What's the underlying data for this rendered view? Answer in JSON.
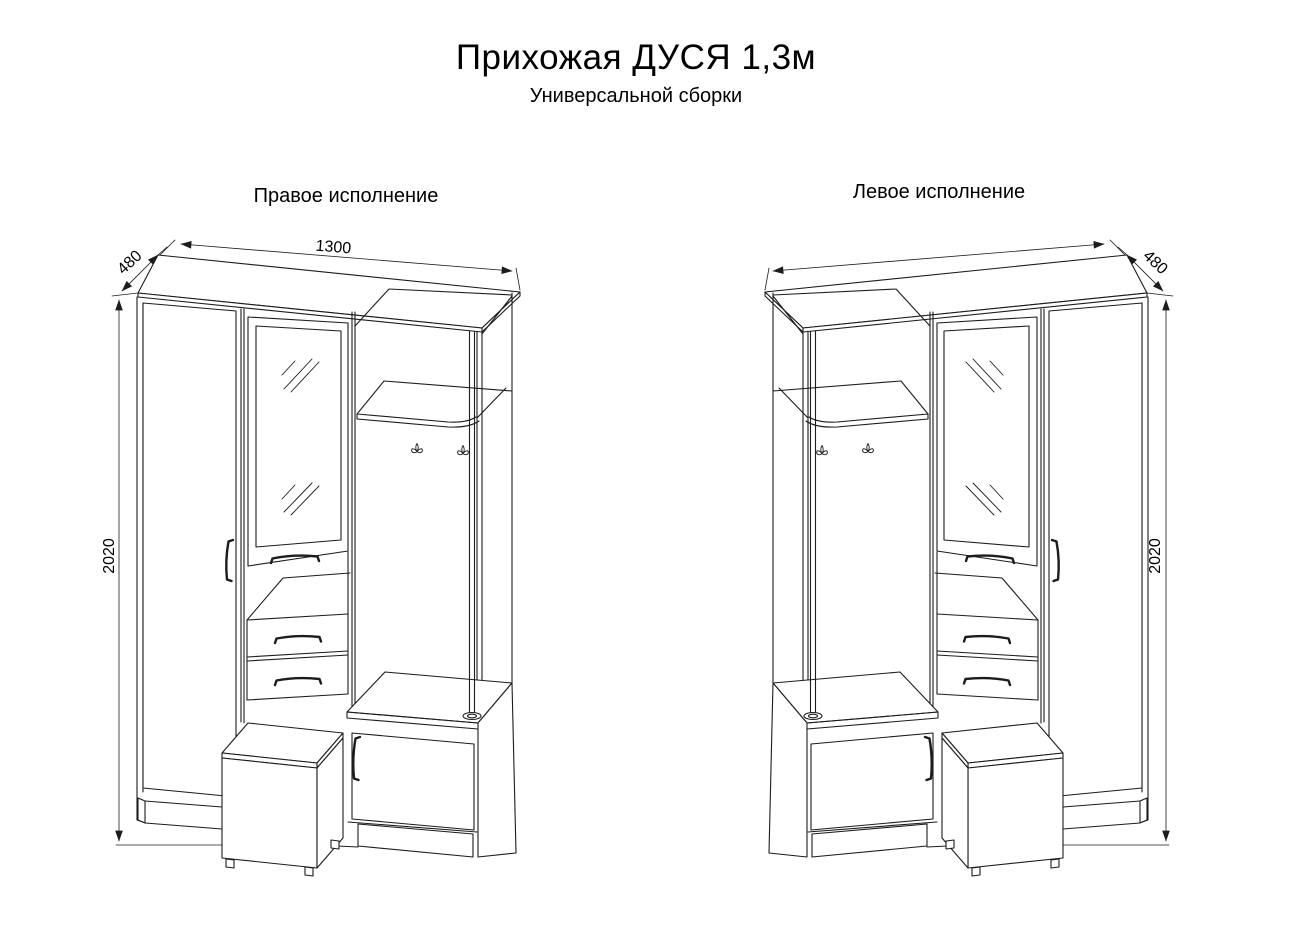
{
  "page": {
    "title": "Прихожая ДУСЯ 1,3м",
    "subtitle": "Универсальной сборки",
    "background_color": "#ffffff",
    "line_color": "#1c1c1c",
    "text_color": "#000000"
  },
  "drawings": [
    {
      "id": "right-version",
      "label": "Правое исполнение",
      "dimensions": {
        "width": "1300",
        "depth": "480",
        "height": "2020"
      },
      "parts": [
        "top-panel",
        "wardrobe-door",
        "mirror-door",
        "open-niche",
        "drawer-1",
        "drawer-2",
        "hat-shelf",
        "coat-hooks",
        "support-post",
        "shoe-bench",
        "pouf-stool"
      ]
    },
    {
      "id": "left-version",
      "label": "Левое исполнение",
      "dimensions": {
        "depth": "480",
        "height": "2020"
      },
      "parts": [
        "top-panel",
        "wardrobe-door",
        "mirror-door",
        "open-niche",
        "drawer-1",
        "drawer-2",
        "hat-shelf",
        "coat-hooks",
        "support-post",
        "shoe-bench",
        "pouf-stool"
      ]
    }
  ]
}
